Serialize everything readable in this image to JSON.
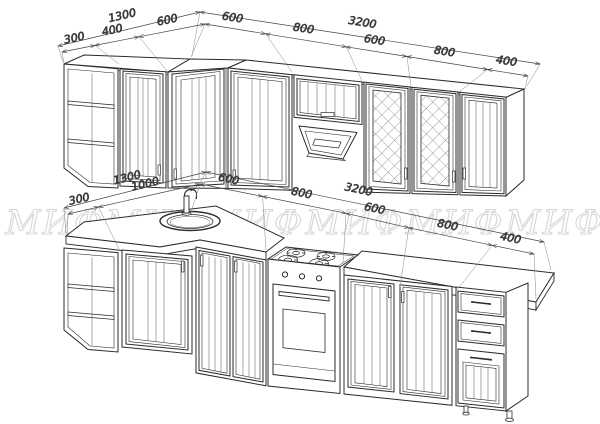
{
  "watermark": {
    "text": "МИФ",
    "color": "#d6d6d6"
  },
  "upper_dims": {
    "overall_left": "1300",
    "left_segments": [
      "300",
      "400",
      "600"
    ],
    "overall_right": "3200",
    "right_segments": [
      "600",
      "800",
      "600",
      "800",
      "400"
    ]
  },
  "lower_dims": {
    "overall_left": "1300",
    "left_segments": [
      "300",
      "1000"
    ],
    "overall_right": "3200",
    "right_segments": [
      "600",
      "800",
      "600",
      "800",
      "400"
    ]
  },
  "drawing": {
    "line_color": "#2b2b2b",
    "dim_color": "#444444"
  }
}
